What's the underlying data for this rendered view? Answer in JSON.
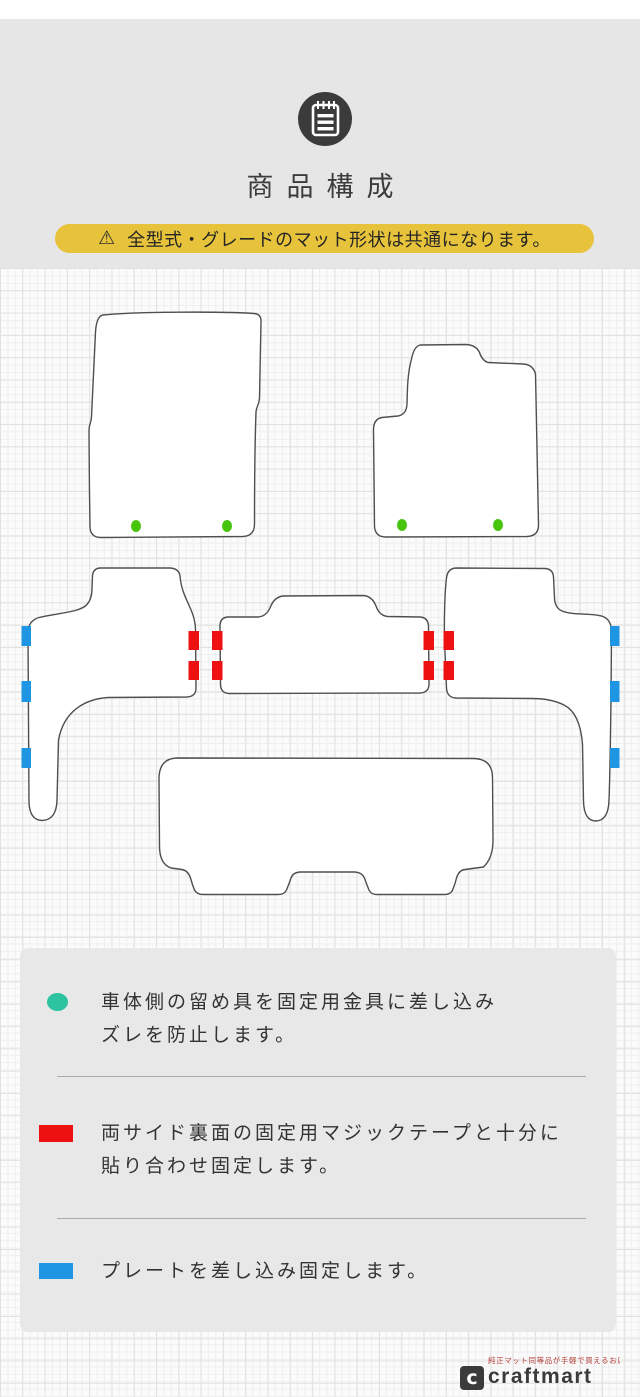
{
  "header": {
    "title": "商品構成",
    "notice": {
      "icon_glyph": "⚠",
      "text": "全型式・グレードのマット形状は共通になります。"
    }
  },
  "diagram": {
    "mats": [
      {
        "name": "front-driver-mat",
        "markers": "2 green hook dots"
      },
      {
        "name": "front-passenger-mat",
        "markers": "2 green hook dots"
      },
      {
        "name": "second-row-left-step-mat",
        "markers": "3 blue plates left, 2 red velcro right"
      },
      {
        "name": "second-row-center-mat",
        "markers": "2 red velcro each side"
      },
      {
        "name": "second-row-right-step-mat",
        "markers": "2 red velcro left, 3 blue plates right"
      },
      {
        "name": "rear-luggage-mat",
        "markers": "none"
      }
    ]
  },
  "colors": {
    "banner_yellow": "#e7c33c",
    "green_dot": "#47c40e",
    "red_tab": "#ee1111",
    "blue_tab": "#1f96e4",
    "teal_dot": "#2dc3a1",
    "legend_red": "#ee1111",
    "legend_blue": "#1f96e4"
  },
  "legend": {
    "items": [
      {
        "marker": "teal-dot",
        "line1": "車体側の留め具を固定用金具に差し込み",
        "line2": "ズレを防止します。"
      },
      {
        "marker": "red-rect",
        "line1": "両サイド裏面の固定用マジックテープと十分に",
        "line2": "貼り合わせ固定します。"
      },
      {
        "marker": "blue-rect",
        "line1": "プレートを差し込み固定します。"
      }
    ]
  },
  "footer": {
    "tagline": "純正マット同等品が手軽で買えるお店",
    "logo_text": "craftmart"
  }
}
